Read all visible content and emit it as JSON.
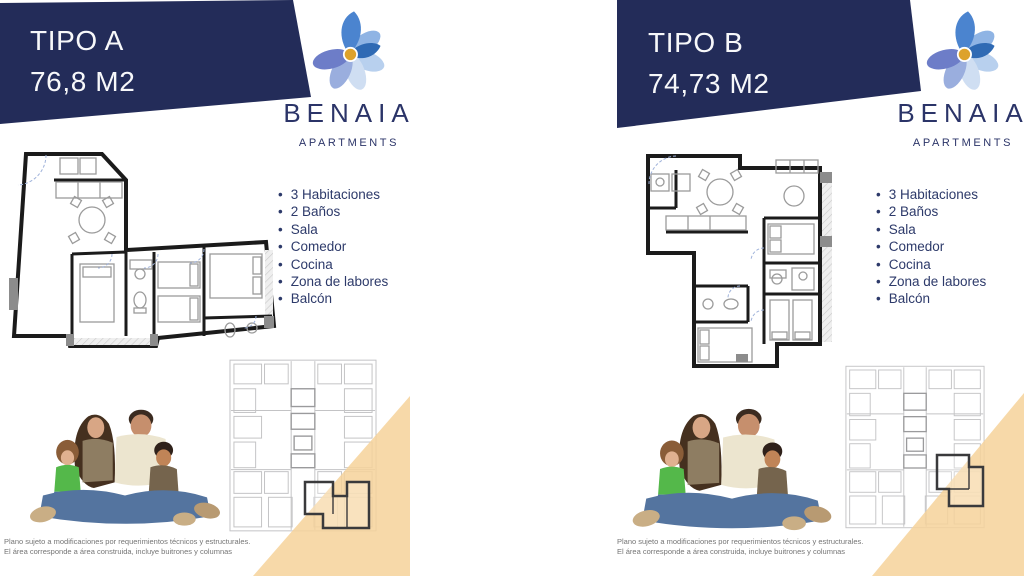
{
  "brand": {
    "name": "BENAIA",
    "tagline": "APARTMENTS"
  },
  "colors": {
    "navy": "#232c59",
    "gold": "#dda22c",
    "orange": "#f6d29a",
    "feature_text": "#2d3a6a"
  },
  "icons": {
    "logo": "benaia-flower-bird-logo"
  },
  "cards": [
    {
      "type_label": "TIPO A",
      "area_label": "76,8 M2",
      "features": [
        "3 Habitaciones",
        "2 Baños",
        "Sala",
        "Comedor",
        "Cocina",
        "Zona de labores",
        "Balcón"
      ],
      "disclaimer": [
        "Plano sujeto a modificaciones por requerimientos técnicos y estructurales.",
        "El área corresponde a área construida, incluye buitrones y columnas"
      ]
    },
    {
      "type_label": "TIPO B",
      "area_label": "74,73 M2",
      "features": [
        "3 Habitaciones",
        "2 Baños",
        "Sala",
        "Comedor",
        "Cocina",
        "Zona de labores",
        "Balcón"
      ],
      "disclaimer": [
        "Plano sujeto a modificaciones por requerimientos técnicos y estructurales.",
        "El área corresponde a área construida, incluye buitrones y columnas"
      ]
    }
  ]
}
